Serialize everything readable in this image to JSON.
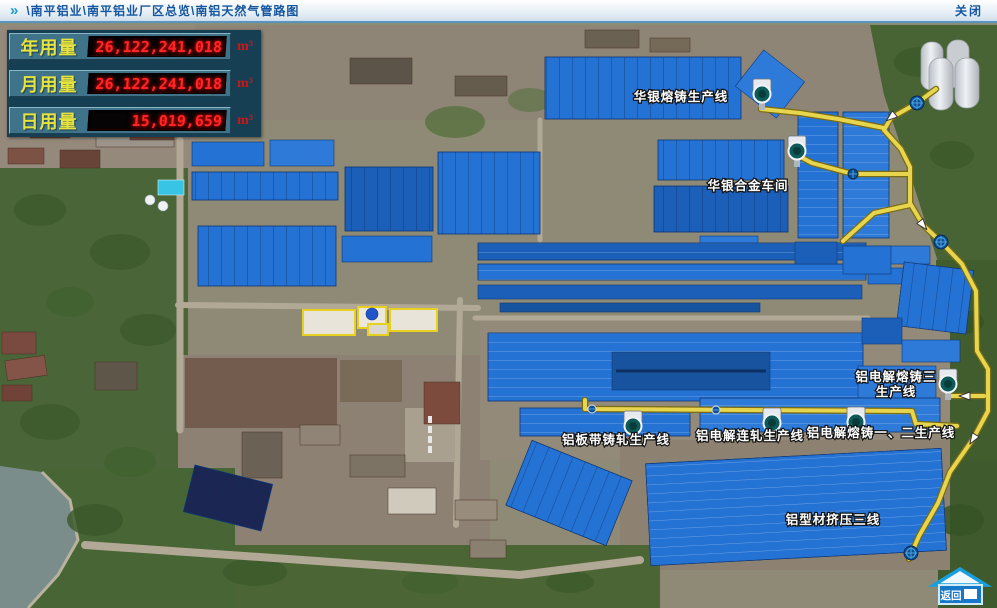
{
  "title_bar": {
    "icon_glyph": "»",
    "breadcrumb": "\\南平铝业\\南平铝业厂区总览\\南铝天然气管路图",
    "close_label": "关闭"
  },
  "usage_panel": {
    "rows": [
      {
        "label": "年用量",
        "value": "26,122,241,018",
        "unit": "m³"
      },
      {
        "label": "月用量",
        "value": "26,122,241,018",
        "unit": "m³"
      },
      {
        "label": "日用量",
        "value": "15,019,659",
        "unit": "m³"
      }
    ]
  },
  "map": {
    "labels": {
      "huayin_casting": "华银熔铸生产线",
      "huayin_alloy": "华银合金车间",
      "elec_casting3_a": "铝电解熔铸三",
      "elec_casting3_b": "生产线",
      "plate_strip": "铝板带铸轧生产线",
      "cont_rolling": "铝电解连轧生产线",
      "casting_1_2": "铝电解熔铸一、二生产线",
      "extrusion3": "铝型材挤压三线"
    }
  },
  "back_button": {
    "label": "返回"
  },
  "colors": {
    "pipeline": "#e8d54e",
    "led_red": "#ff2626",
    "label_yellow": "#e6e23e",
    "roof_blue": "#2472d4"
  }
}
